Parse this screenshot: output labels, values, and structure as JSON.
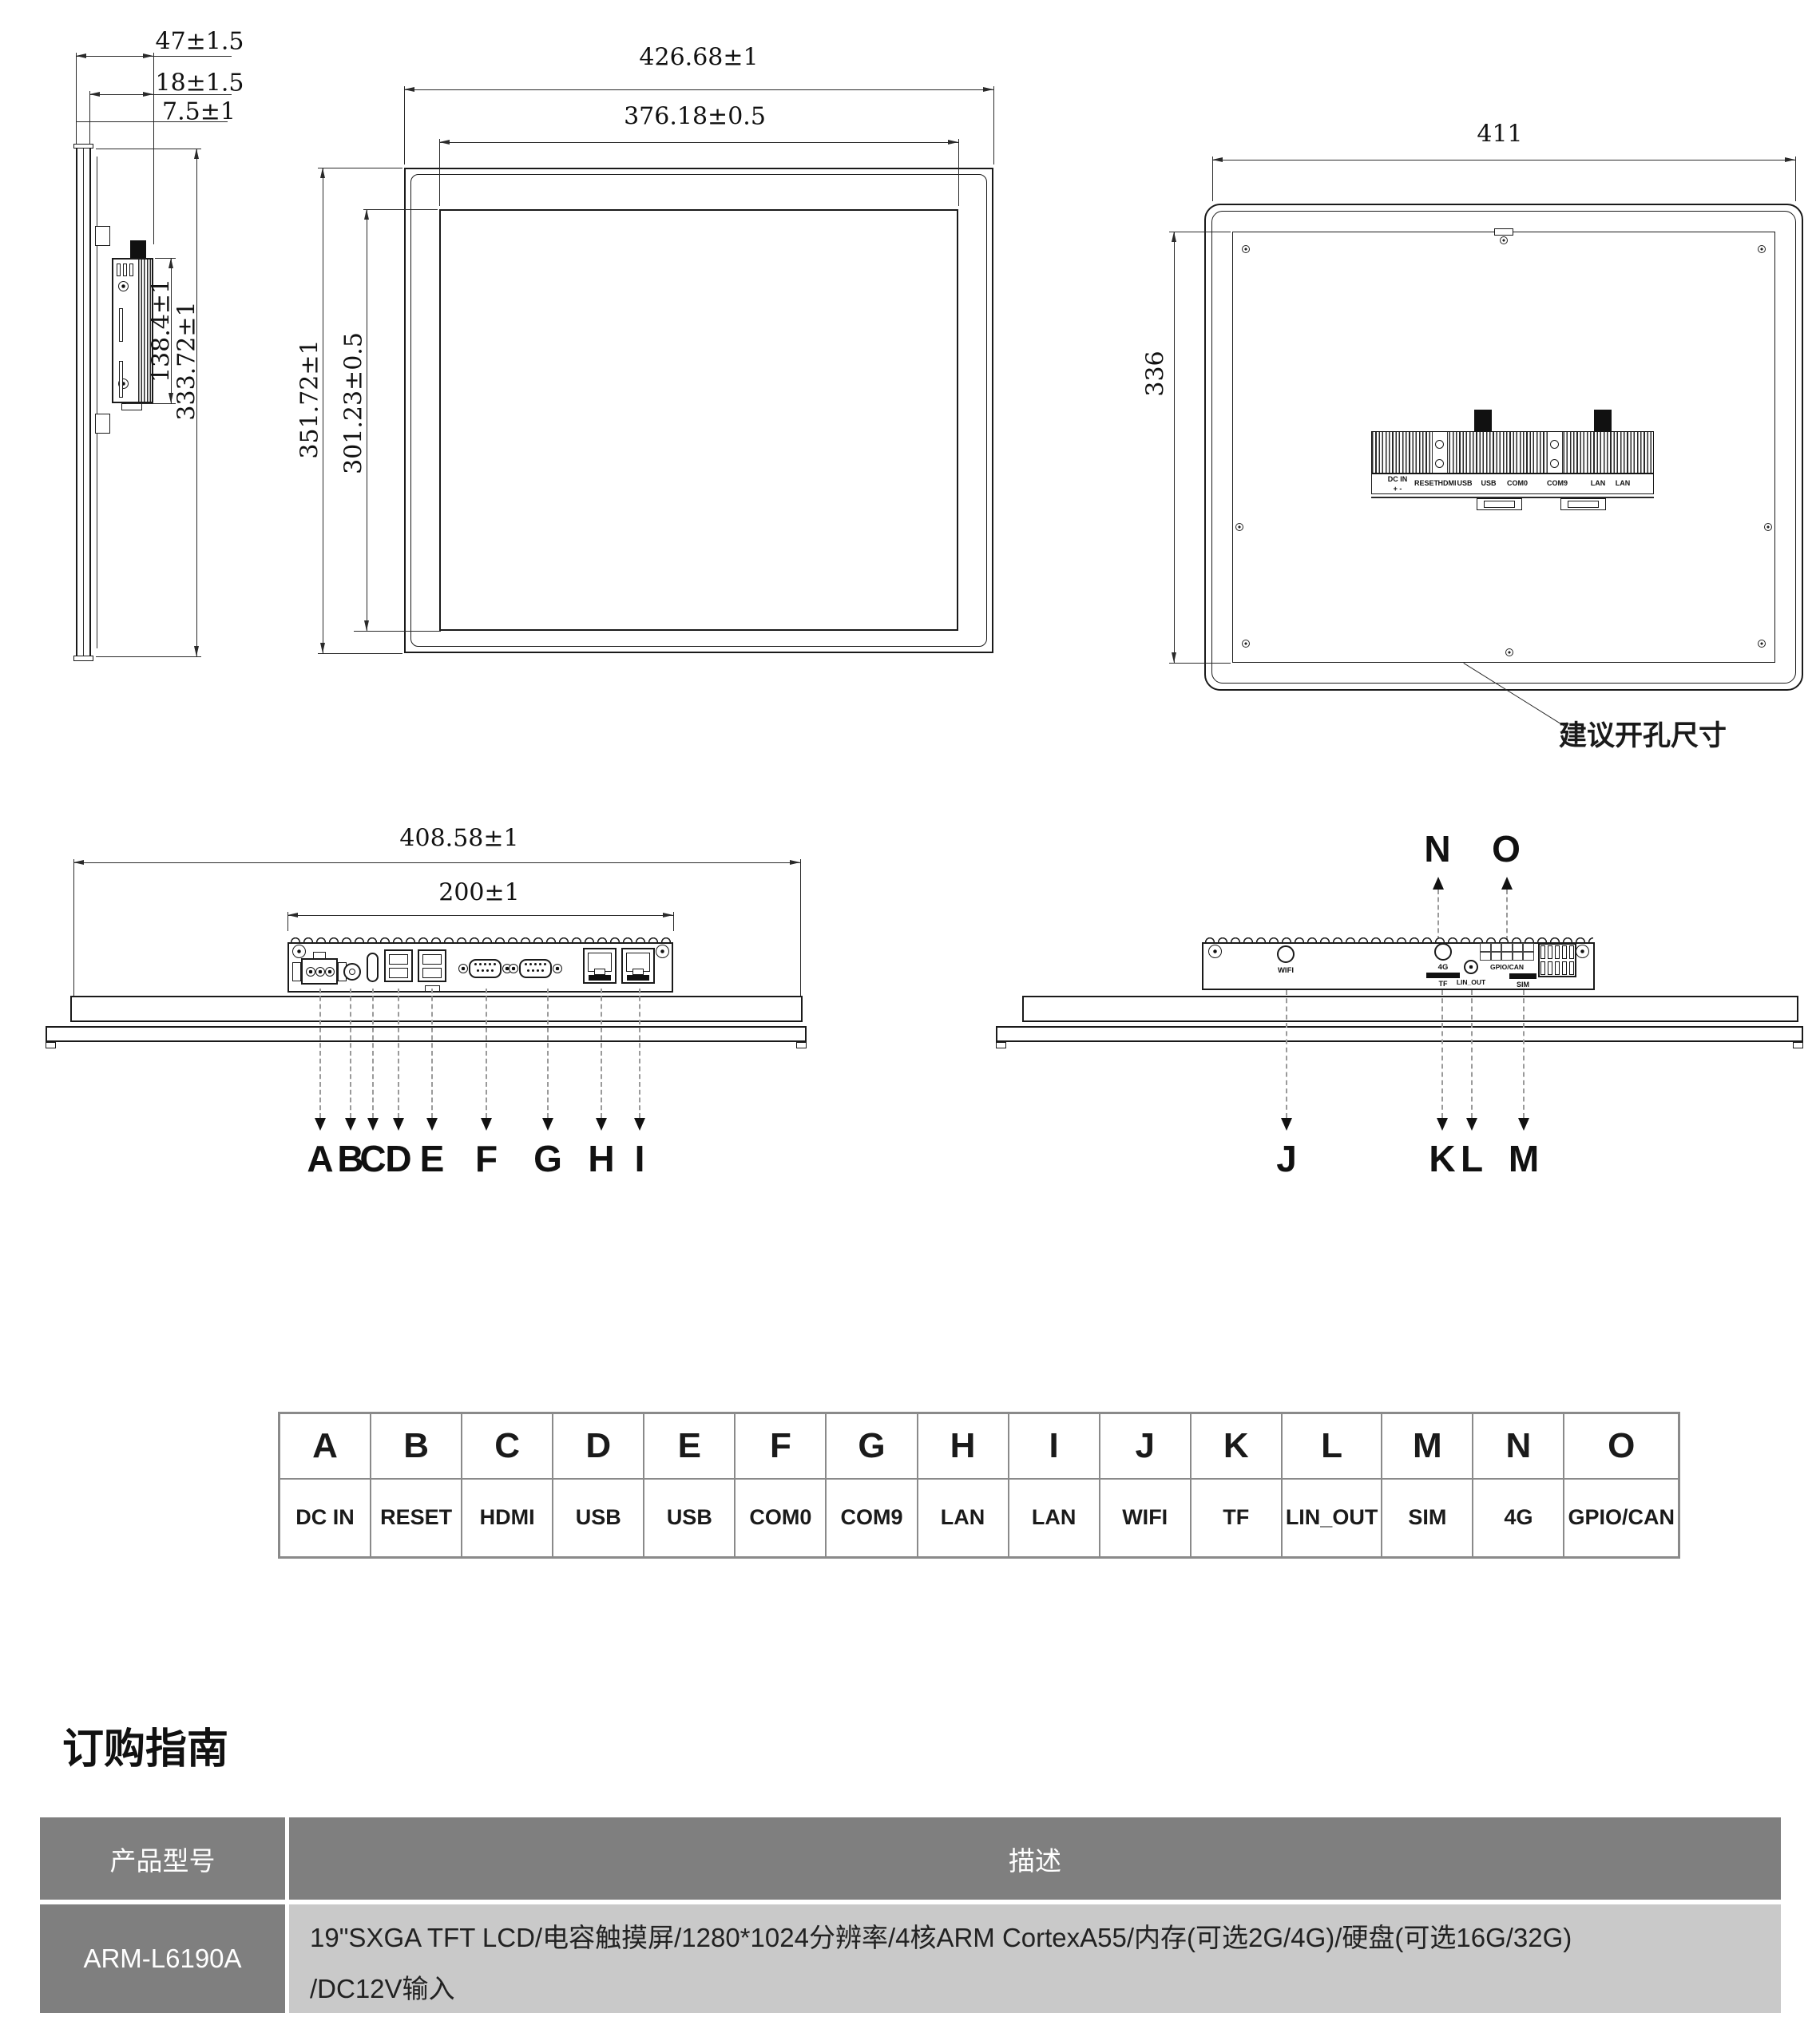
{
  "colors": {
    "line": "#1a1a1a",
    "dim": "#2a2a2a",
    "dash": "#9a9a9a",
    "legend_border": "#8a8a8a",
    "header_bg": "#7f7f7f",
    "row_bg": "#c9c9c9",
    "header_text": "#ffffff",
    "text": "#1a1a1a",
    "page_bg": "#ffffff"
  },
  "drawing": {
    "side_view": {
      "dim_depth_total": "47±1.5",
      "dim_depth_mid": "18±1.5",
      "dim_depth_front": "7.5±1",
      "dim_module_height": "138.4±1",
      "dim_body_height": "333.72±1"
    },
    "front_view": {
      "dim_width_outer": "426.68±1",
      "dim_width_inner": "376.18±0.5",
      "dim_height_outer": "351.72±1",
      "dim_height_inner": "301.23±0.5"
    },
    "back_view": {
      "dim_width": "411",
      "dim_height": "336",
      "cutout_note": "建议开孔尺寸",
      "dc_polarity": "+  -",
      "strip_labels": [
        "DC IN",
        "RESET",
        "HDMI",
        "USB",
        "USB",
        "COM0",
        "COM9",
        "LAN",
        "LAN"
      ]
    },
    "bottom_view_front": {
      "dim_width": "408.58±1",
      "dim_module_width": "200±1",
      "callouts": [
        "A",
        "B",
        "C",
        "D",
        "E",
        "F",
        "G",
        "H",
        "I"
      ]
    },
    "bottom_view_rear": {
      "callouts_up": [
        "N",
        "O"
      ],
      "callouts_down": [
        "J",
        "K",
        "L",
        "M"
      ],
      "port_labels": {
        "wifi": "WIFI",
        "fourg": "4G",
        "tf": "TF",
        "lin_out": "LIN_OUT",
        "gpio_can": "GPIO/CAN",
        "sim": "SIM"
      }
    }
  },
  "port_legend": {
    "columns": [
      {
        "key": "A",
        "name": "DC IN"
      },
      {
        "key": "B",
        "name": "RESET"
      },
      {
        "key": "C",
        "name": "HDMI"
      },
      {
        "key": "D",
        "name": "USB"
      },
      {
        "key": "E",
        "name": "USB"
      },
      {
        "key": "F",
        "name": "COM0"
      },
      {
        "key": "G",
        "name": "COM9"
      },
      {
        "key": "H",
        "name": "LAN"
      },
      {
        "key": "I",
        "name": "LAN"
      },
      {
        "key": "J",
        "name": "WIFI"
      },
      {
        "key": "K",
        "name": "TF"
      },
      {
        "key": "L",
        "name": "LIN_OUT"
      },
      {
        "key": "M",
        "name": "SIM"
      },
      {
        "key": "N",
        "name": "4G"
      },
      {
        "key": "O",
        "name": "GPIO/CAN"
      }
    ]
  },
  "order_guide": {
    "heading": "订购指南",
    "model_header": "产品型号",
    "desc_header": "描述",
    "rows": [
      {
        "model": "ARM-L6190A",
        "description_line1": "19\"SXGA TFT LCD/电容触摸屏/1280*1024分辨率/4核ARM CortexA55/内存(可选2G/4G)/硬盘(可选16G/32G)",
        "description_line2": "/DC12V输入"
      }
    ]
  }
}
